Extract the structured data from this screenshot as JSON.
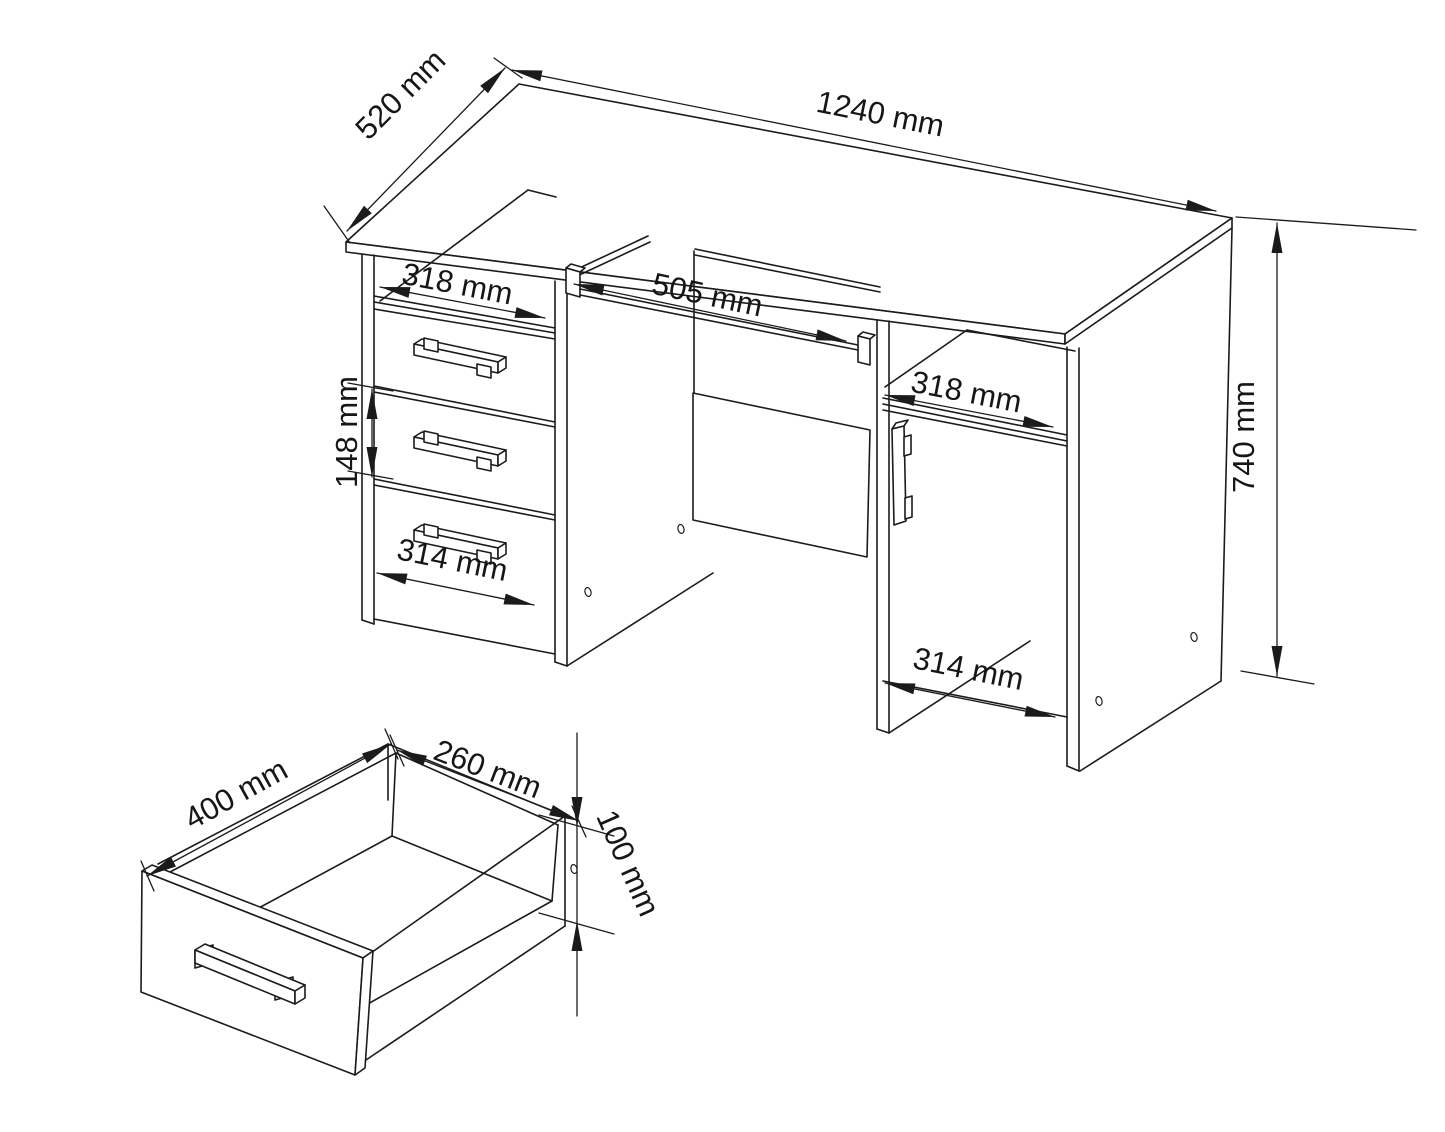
{
  "drawing": {
    "type": "furniture-dimension-diagram",
    "subject": "computer desk with drawer pedestal, door pedestal and keyboard tray, plus drawer box detail",
    "background_color": "#ffffff",
    "line_color": "#1b1b1b",
    "text_color": "#161616",
    "dimensions": {
      "desk_depth": "520 mm",
      "desk_width": "1240 mm",
      "left_shelf_opening": "318 mm",
      "keyboard_tray_width": "505 mm",
      "drawer_front_height": "148 mm",
      "left_drawer_front_width": "314 mm",
      "right_shelf_opening": "318 mm",
      "right_door_width": "314 mm",
      "desk_height": "740 mm",
      "drawer_box_depth": "400 mm",
      "drawer_box_width": "260 mm",
      "drawer_box_height": "100 mm"
    }
  }
}
